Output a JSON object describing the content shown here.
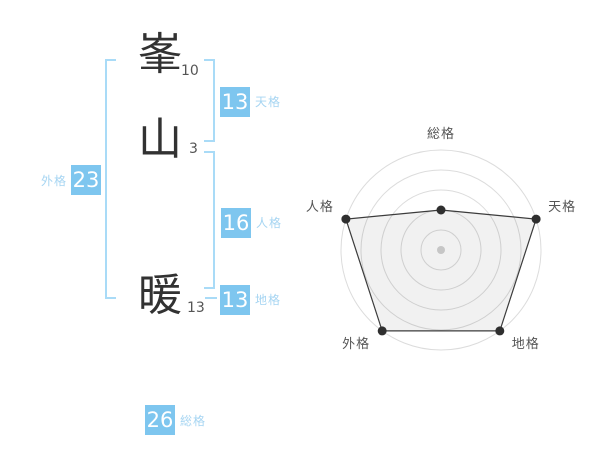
{
  "name_panel": {
    "characters": [
      {
        "char": "峯",
        "strokes": "10"
      },
      {
        "char": "山",
        "strokes": "3"
      },
      {
        "char": "暖",
        "strokes": "13"
      }
    ],
    "categories": {
      "tenkaku": {
        "label": "天格",
        "value": "13"
      },
      "jinkaku": {
        "label": "人格",
        "value": "16"
      },
      "chikaku": {
        "label": "地格",
        "value": "13"
      },
      "gaikaku": {
        "label": "外格",
        "value": "23"
      },
      "soukaku": {
        "label": "総格",
        "value": "26"
      }
    }
  },
  "chart_data": {
    "type": "radar",
    "axes": [
      "総格",
      "天格",
      "地格",
      "外格",
      "人格"
    ],
    "values": [
      2,
      5,
      5,
      5,
      5
    ],
    "value_max": 5,
    "rings": 5,
    "start_angle_deg": 90,
    "direction": "clockwise",
    "legend": false,
    "colors": {
      "grid": "#dcdcdc",
      "shape_fill": "rgba(0,0,0,0.055)",
      "shape_stroke": "#3c3c3c",
      "point": "#2f2f2f",
      "center_point": "#c6c6c6",
      "axis_label": "#555555"
    }
  },
  "colors": {
    "value_box": "#7ec6ef",
    "category_label": "#a6d5f2",
    "bracket_line": "#a9dbf7",
    "kanji_text": "#323232",
    "stroke_count_text": "#555555",
    "background": "#ffffff"
  }
}
